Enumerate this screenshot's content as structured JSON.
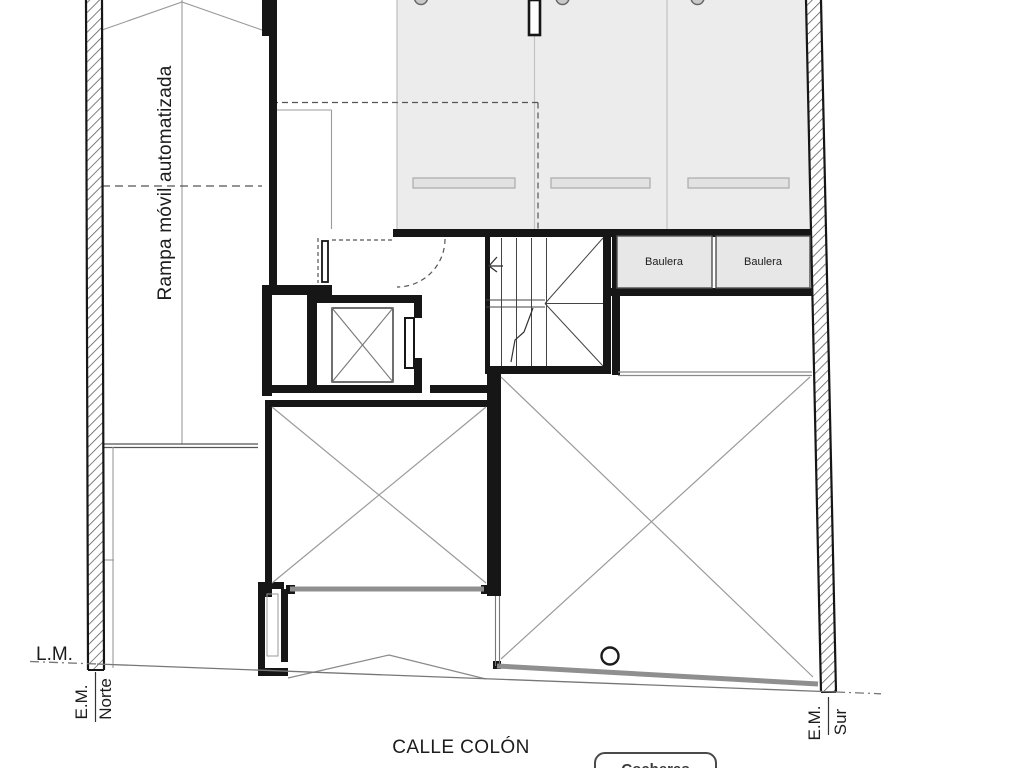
{
  "plan": {
    "ramp_label": "Rampa móvil automatizada",
    "bauleras": [
      "Baulera",
      "Baulera"
    ],
    "lm_label": "L.M.",
    "em_norte": {
      "axis": "E.M.",
      "direction": "Norte"
    },
    "em_sur": {
      "axis": "E.M.",
      "direction": "Sur"
    },
    "street_label": "CALLE COLÓN",
    "button_label": "Cocheras"
  },
  "colors": {
    "wall_black": "#161616",
    "parking_fill": "#ececec",
    "baulera_fill": "#e7e7e7",
    "wheelstop_fill": "#e2e2e2",
    "heavy_gray_line": "#8f8f8f",
    "thin_line": "#999999",
    "hatch_line": "#555555"
  }
}
